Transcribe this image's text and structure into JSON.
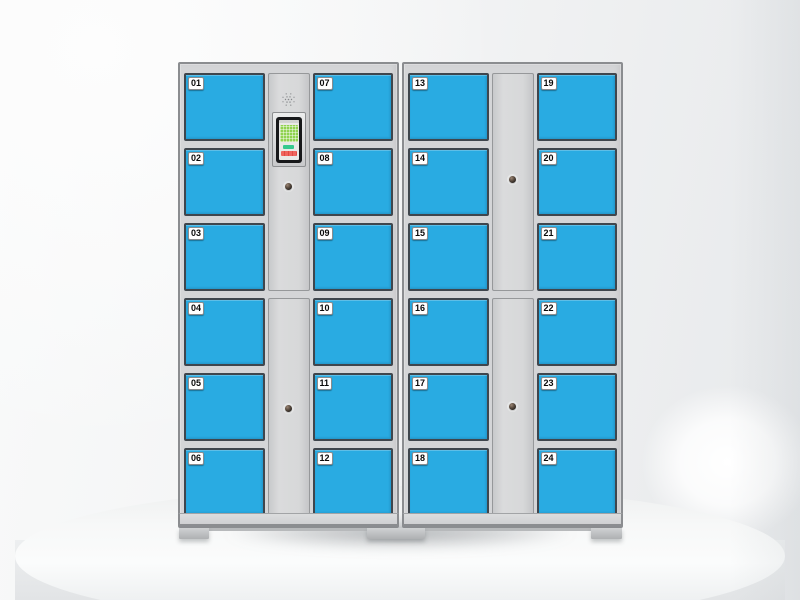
{
  "product": {
    "name": "smart-locker-cabinet",
    "door_color": "#29abe2",
    "frame_color": "#d4d5d7",
    "door_border_color": "#3f464d",
    "cabinets": [
      {
        "left_doors": [
          "01",
          "02",
          "03",
          "04",
          "05",
          "06"
        ],
        "right_doors": [
          "07",
          "08",
          "09",
          "10",
          "11",
          "12"
        ],
        "panel": {
          "type": "control",
          "upper_features": [
            "speaker-grille",
            "touchscreen",
            "keyhole"
          ],
          "lower_features": [
            "keyhole"
          ]
        }
      },
      {
        "left_doors": [
          "13",
          "14",
          "15",
          "16",
          "17",
          "18"
        ],
        "right_doors": [
          "19",
          "20",
          "21",
          "22",
          "23",
          "24"
        ],
        "panel": {
          "type": "blank",
          "upper_features": [
            "keyhole"
          ],
          "lower_features": [
            "keyhole"
          ]
        }
      }
    ]
  },
  "screen": {
    "colors": {
      "bezel": "#17181a",
      "lcd_green": "#90d24f",
      "button_green": "#35c98e",
      "button_red": "#ef625b"
    }
  },
  "scene": {
    "background": "#f1f2f3",
    "pedestal": "#f7f8f8",
    "pedestal_shape": "white-cylinder-podium"
  }
}
